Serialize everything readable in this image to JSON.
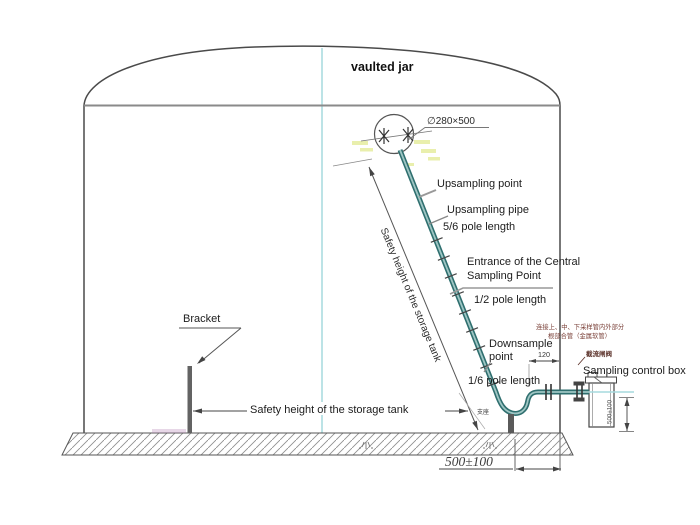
{
  "diagram": {
    "type": "technical-drawing",
    "title": "vaulted jar",
    "labels": {
      "manhole_dim": "∅280×500",
      "upsampling_point": "Upsampling point",
      "upsampling_pipe": "Upsampling pipe",
      "pole_length_5_6": "5/6 pole length",
      "entrance_line1": "Entrance of the Central",
      "entrance_line2": "Sampling Point",
      "pole_length_1_2": "1/2 pole length",
      "downsample_line1": "Downsample",
      "downsample_line2": "point",
      "pole_length_1_6": "1/6 pole length",
      "sampling_control_box": "Sampling control box",
      "bracket": "Bracket",
      "safety_height_diagonal": "Safety height of the storage tank",
      "safety_height_horizontal": "Safety height of the storage tank",
      "ground_offset_dim": "500±100",
      "box_height_dim": "500±100",
      "wall_offset_dim": "120",
      "cn_note_line1": "连接上、中、下采样管内外部分",
      "cn_note_line2": "根部合管（金属软管）",
      "cn_valve_label": "截流闸阀",
      "cn_support_label": "支座"
    },
    "colors": {
      "pipe_teal": "#2f6f6f",
      "pipe_highlight": "#9fc6c4",
      "centerline_cyan": "#a5dade",
      "highlight_yellow": "#e9efad",
      "annotation_red": "#7a4038",
      "line_dark": "#4a4a4a"
    }
  }
}
